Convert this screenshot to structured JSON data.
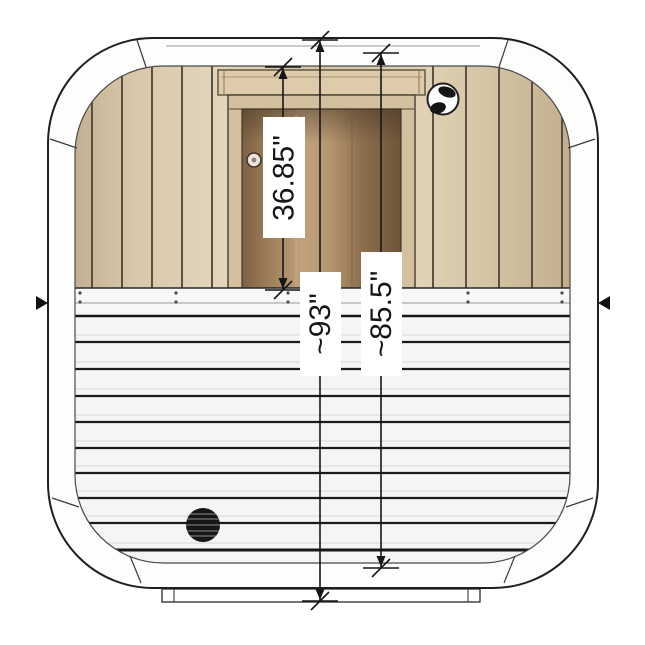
{
  "diagram": {
    "dimensions": {
      "door_height": "36.85\"",
      "overall_height": "~93\"",
      "interior_height": "~85.5\""
    },
    "icons": {
      "air_vent": "round-air-vent",
      "drain_vent": "round-drain-vent",
      "left_marker": "seam-arrow-left",
      "right_marker": "seam-arrow-right"
    },
    "colors": {
      "line": "#1f1f1f",
      "wood_panel": "#d9c8ab",
      "door_glass": "#a5855f",
      "slat_wall": "#f5f5f3",
      "frame": "#fdfdfc"
    }
  }
}
